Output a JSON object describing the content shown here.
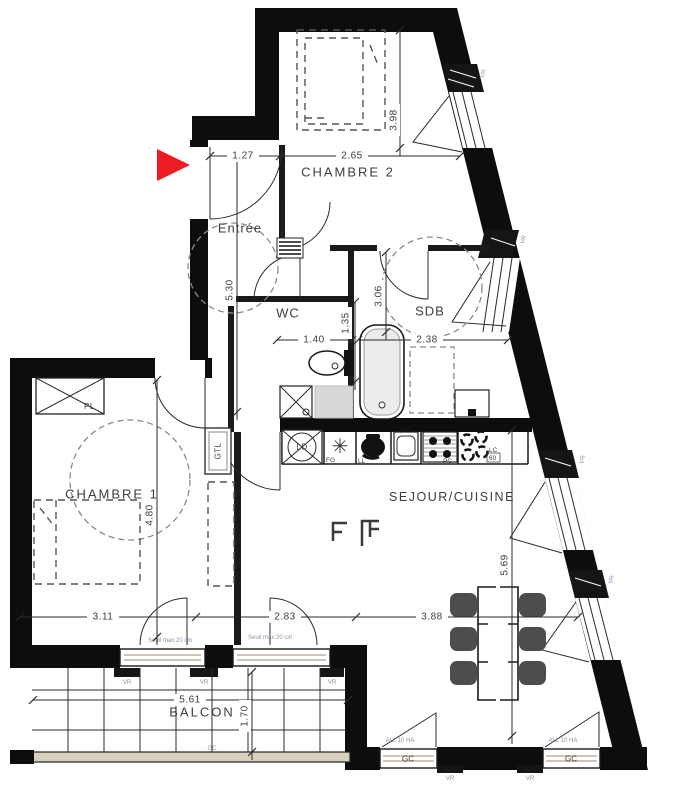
{
  "rooms": {
    "chambre2": "CHAMBRE 2",
    "entree": "Entrée",
    "wc": "WC",
    "sdb": "SDB",
    "chambre1": "CHAMBRE 1",
    "sejour": "SEJOUR/CUISINE",
    "balcon": "BALCON"
  },
  "dims": {
    "entry_width": "1.27",
    "chambre2_width": "2.65",
    "chambre2_depth": "3.98",
    "hall_depth": "5.30",
    "wc_width": "1.40",
    "wc_depth": "1.35",
    "sdb_depth": "3.06",
    "sdb_width": "2.38",
    "chambre1_depth": "4.80",
    "chambre1_width": "3.11",
    "sejour_bay_width": "2.83",
    "sejour_width": "3.88",
    "sejour_depth": "5.69",
    "balcon_width": "5.61",
    "balcon_depth": "1.70"
  },
  "labels": {
    "placard": "PL",
    "gtl": "GTL",
    "lave_linge": "LD",
    "refrigerateur": "FG",
    "four": "LL",
    "plaque_cuisson": "PC",
    "lc": "LC",
    "lc_size": "60",
    "garde_corps": "GC",
    "volet_roulant": "VR",
    "seuil": "Seuil max 20 cm",
    "allege": "ALL 10 HA"
  },
  "colors": {
    "entrance_arrow": "#ed1c24",
    "walls": "#0d0d0d",
    "railing": "#d9d0c0",
    "annotation": "#8892a8"
  }
}
